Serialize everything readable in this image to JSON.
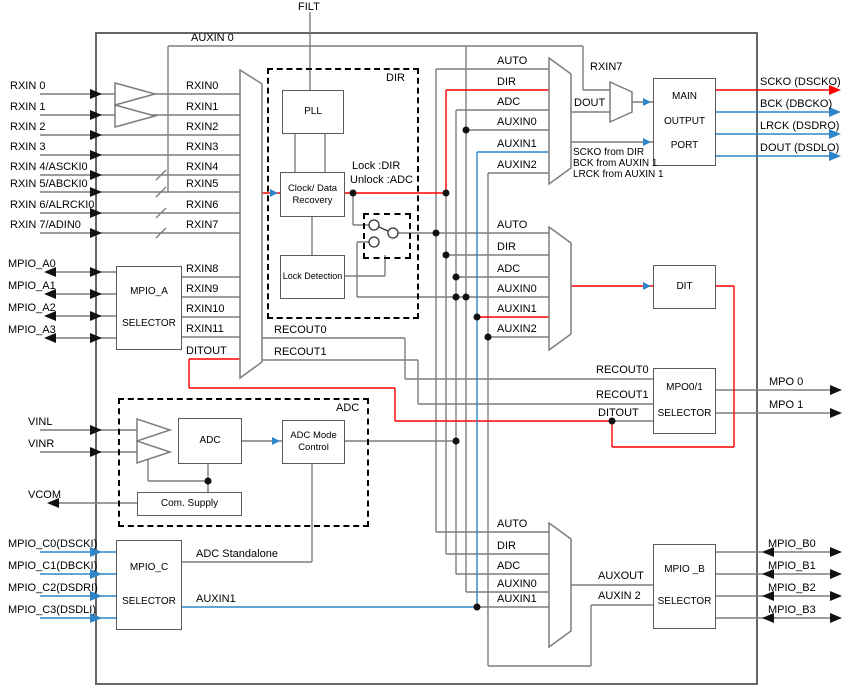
{
  "colors": {
    "red": "#ff0000",
    "blue": "#2e86c8",
    "wire": "#7d7d7d",
    "border": "#5a5a5a",
    "text": "#000000"
  },
  "top": {
    "filt": "FILT",
    "auxin0": "AUXIN 0",
    "rxin7": "RXIN7"
  },
  "pins": {
    "rxin": [
      "RXIN 0",
      "RXIN 1",
      "RXIN 2",
      "RXIN 3",
      "RXIN 4/ASCKI0",
      "RXIN 5/ABCKI0",
      "RXIN 6/ALRCKI0",
      "RXIN 7/ADIN0"
    ],
    "mpio_a": [
      "MPIO_A0",
      "MPIO_A1",
      "MPIO_A2",
      "MPIO_A3"
    ],
    "vin": [
      "VINL",
      "VINR"
    ],
    "vcom": "VCOM",
    "mpio_c": [
      "MPIO_C0(DSCKI)",
      "MPIO_C1(DBCKI)",
      "MPIO_C2(DSDRI)",
      "MPIO_C3(DSDLI)"
    ],
    "mpio_b": [
      "MPIO_B0",
      "MPIO_B1",
      "MPIO_B2",
      "MPIO_B3"
    ],
    "mpo": [
      "MPO 0",
      "MPO 1"
    ],
    "main_out": [
      "SCKO (DSCKO)",
      "BCK (DBCKO)",
      "LRCK (DSDRO)",
      "DOUT (DSDLO)"
    ]
  },
  "inner": {
    "rxin_buf": [
      "RXIN0",
      "RXIN1",
      "RXIN2",
      "RXIN3",
      "RXIN4",
      "RXIN5",
      "RXIN6",
      "RXIN7"
    ],
    "mpio_a_out": [
      "RXIN8",
      "RXIN9",
      "RXIN10",
      "RXIN11"
    ],
    "ditout_mux": "DITOUT",
    "recout_mux": [
      "RECOUT0",
      "RECOUT1"
    ],
    "dout": "DOUT",
    "auxout": "AUXOUT",
    "auxin1_out": "AUXIN1",
    "auxin2_in": "AUXIN 2",
    "adc_standalone": "ADC Standalone"
  },
  "dir_area": {
    "title": "DIR",
    "lock1": "Lock :DIR",
    "lock2": "Unlock :ADC"
  },
  "adc_area": {
    "title": "ADC"
  },
  "mux_inputs": {
    "m1": [
      "AUTO",
      "DIR",
      "ADC",
      "AUXIN0",
      "AUXIN1",
      "AUXIN2"
    ],
    "m2": [
      "AUTO",
      "DIR",
      "ADC",
      "AUXIN0",
      "AUXIN1",
      "AUXIN2"
    ],
    "m3": [
      "AUTO",
      "DIR",
      "ADC",
      "AUXIN0",
      "AUXIN1"
    ]
  },
  "mpo_sel_inputs": {
    "recout0": "RECOUT0",
    "recout1": "RECOUT1",
    "ditout": "DITOUT"
  },
  "notes": {
    "port": [
      "SCKO from DIR",
      "BCK from AUXIN 1",
      "LRCK from AUXIN 1"
    ]
  },
  "blocks": {
    "mpio_a": [
      "MPIO_A",
      "SELECTOR"
    ],
    "pll": "PLL",
    "cdr": [
      "Clock/ Data",
      "Recovery"
    ],
    "lock_detection": "Lock Detection",
    "adc": "ADC",
    "adc_mode": [
      "ADC Mode",
      "Control"
    ],
    "com_supply": "Com. Supply",
    "mpio_c": [
      "MPIO_C",
      "SELECTOR"
    ],
    "main_output_port": [
      "MAIN",
      "OUTPUT",
      "PORT"
    ],
    "dit": "DIT",
    "mpo": [
      "MPO0/1",
      "SELECTOR"
    ],
    "mpio_b": [
      "MPIO _B",
      "SELECTOR"
    ]
  }
}
